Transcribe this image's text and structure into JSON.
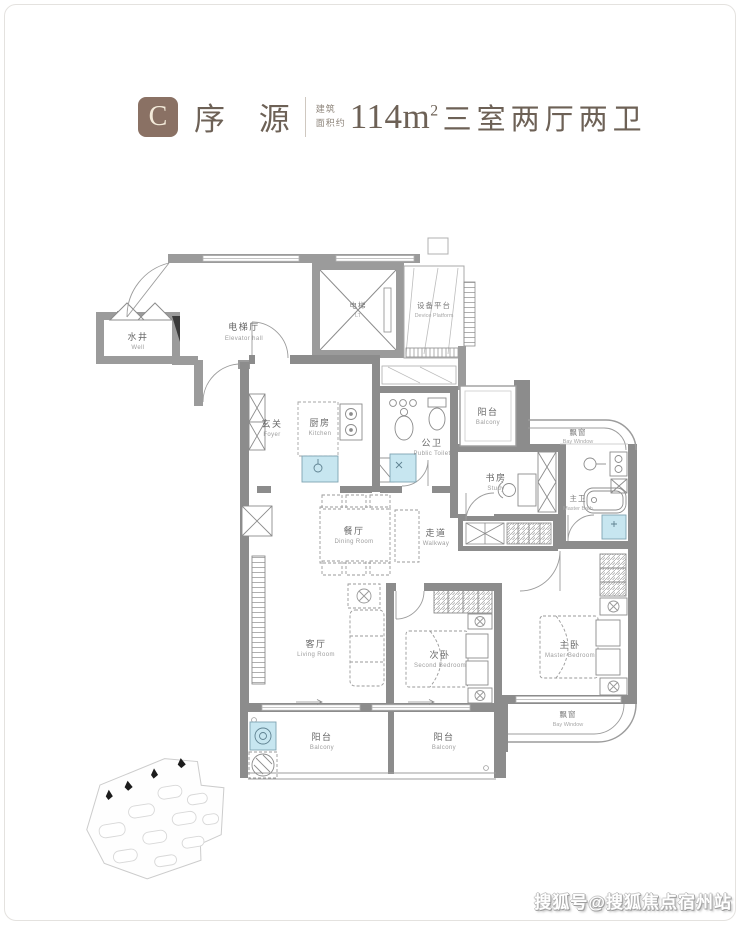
{
  "header": {
    "unit_letter": "C",
    "unit_name": "序 源",
    "area_label_line1": "建筑",
    "area_label_line2": "面积约",
    "area_value": "114m",
    "area_superscript": "2",
    "spec": "三室两厅两卫",
    "accent_color": "#8a7164",
    "text_color": "#6d6156"
  },
  "floorplan": {
    "rooms": {
      "well": {
        "zh": "水井",
        "en": "Well"
      },
      "elevator_hall": {
        "zh": "电梯厅",
        "en": "Elevator hall"
      },
      "elevator": {
        "zh": "电梯",
        "en": "LT"
      },
      "device_platform": {
        "zh": "设备平台",
        "en": "Device Platform"
      },
      "foyer": {
        "zh": "玄关",
        "en": "Foyer"
      },
      "kitchen": {
        "zh": "厨房",
        "en": "Kitchen"
      },
      "public_toilet": {
        "zh": "公卫",
        "en": "Public Toilet"
      },
      "balcony_top": {
        "zh": "阳台",
        "en": "Balcony"
      },
      "bay_window_top": {
        "zh": "飘窗",
        "en": "Bay Window"
      },
      "study": {
        "zh": "书房",
        "en": "Study"
      },
      "master_bath": {
        "zh": "主卫",
        "en": "Master Bath"
      },
      "dining_room": {
        "zh": "餐厅",
        "en": "Dining Room"
      },
      "walkway": {
        "zh": "走道",
        "en": "Walkway"
      },
      "living_room": {
        "zh": "客厅",
        "en": "Living Room"
      },
      "second_bedroom": {
        "zh": "次卧",
        "en": "Second Bedroom"
      },
      "master_bedroom": {
        "zh": "主卧",
        "en": "Master Bedroom"
      },
      "bay_window_bottom": {
        "zh": "飘窗",
        "en": "Bay Window"
      },
      "balcony_bottom_left": {
        "zh": "阳台",
        "en": "Balcony"
      },
      "balcony_bottom_right": {
        "zh": "阳台",
        "en": "Balcony"
      }
    },
    "wall_color": "#8c8c8c",
    "fixture_color": "#c7e6f0"
  },
  "watermark": {
    "text": "搜狐号@搜狐焦点宿州站"
  }
}
